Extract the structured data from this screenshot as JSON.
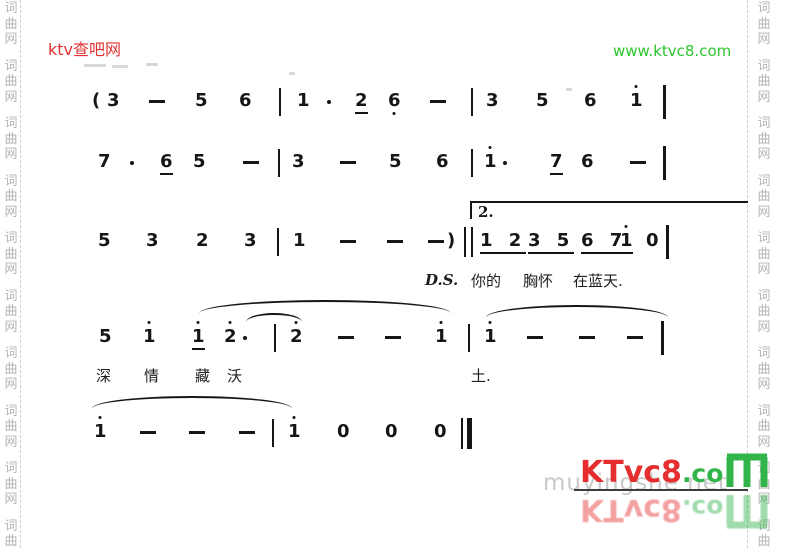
{
  "header": {
    "site_name": "ktv查吧网",
    "site_url": "www.ktvc8.com"
  },
  "side_watermark": {
    "chars": [
      "词",
      "曲",
      "网"
    ],
    "repeat": 10
  },
  "score": {
    "lines": [
      {
        "y": 91,
        "tokens": [
          {
            "k": "paren",
            "t": "(",
            "x": 92
          },
          {
            "k": "note",
            "t": "3",
            "x": 107
          },
          {
            "k": "dash",
            "x": 149
          },
          {
            "k": "note",
            "t": "5",
            "x": 195
          },
          {
            "k": "note",
            "t": "6",
            "x": 239
          },
          {
            "k": "bar",
            "x": 279
          },
          {
            "k": "note",
            "t": "1",
            "x": 297
          },
          {
            "k": "dot",
            "x": 327
          },
          {
            "k": "note",
            "t": "2",
            "x": 355,
            "ul": true
          },
          {
            "k": "note",
            "t": "6",
            "x": 388,
            "db": true
          },
          {
            "k": "dash",
            "x": 430
          },
          {
            "k": "bar",
            "x": 471
          },
          {
            "k": "note",
            "t": "3",
            "x": 486
          },
          {
            "k": "note",
            "t": "5",
            "x": 536
          },
          {
            "k": "note",
            "t": "6",
            "x": 584
          },
          {
            "k": "note",
            "t": "1",
            "x": 630,
            "da": true
          },
          {
            "k": "ebar",
            "x": 663
          }
        ]
      },
      {
        "y": 152,
        "tokens": [
          {
            "k": "note",
            "t": "7",
            "x": 98
          },
          {
            "k": "dot",
            "x": 130
          },
          {
            "k": "note",
            "t": "6",
            "x": 160,
            "ul": true
          },
          {
            "k": "note",
            "t": "5",
            "x": 193
          },
          {
            "k": "dash",
            "x": 243
          },
          {
            "k": "bar",
            "x": 278
          },
          {
            "k": "note",
            "t": "3",
            "x": 292
          },
          {
            "k": "dash",
            "x": 340
          },
          {
            "k": "note",
            "t": "5",
            "x": 389
          },
          {
            "k": "note",
            "t": "6",
            "x": 436
          },
          {
            "k": "bar",
            "x": 471
          },
          {
            "k": "note",
            "t": "1",
            "x": 484,
            "da": true
          },
          {
            "k": "dot",
            "x": 503
          },
          {
            "k": "note",
            "t": "7",
            "x": 550,
            "ul": true
          },
          {
            "k": "note",
            "t": "6",
            "x": 581
          },
          {
            "k": "dash",
            "x": 630
          },
          {
            "k": "ebar",
            "x": 663
          }
        ]
      },
      {
        "y": 231,
        "tokens": [
          {
            "k": "note",
            "t": "5",
            "x": 98
          },
          {
            "k": "note",
            "t": "3",
            "x": 146
          },
          {
            "k": "note",
            "t": "2",
            "x": 196
          },
          {
            "k": "note",
            "t": "3",
            "x": 244
          },
          {
            "k": "bar",
            "x": 277
          },
          {
            "k": "note",
            "t": "1",
            "x": 293
          },
          {
            "k": "dash",
            "x": 340
          },
          {
            "k": "dash",
            "x": 387
          },
          {
            "k": "dash",
            "x": 428
          },
          {
            "k": "paren",
            "t": ")",
            "x": 447
          },
          {
            "k": "dbar",
            "x": 464
          },
          {
            "k": "grp",
            "t": "1 2",
            "x": 480,
            "ul": true
          },
          {
            "k": "grp",
            "t": "3 5",
            "x": 528,
            "ul": true
          },
          {
            "k": "grp",
            "t": "6 7",
            "x": 581,
            "ul": true
          },
          {
            "k": "note",
            "t": "1",
            "x": 620,
            "ul": true,
            "da": true
          },
          {
            "k": "note",
            "t": "0",
            "x": 646
          },
          {
            "k": "ebar",
            "x": 666
          }
        ]
      },
      {
        "y": 327,
        "tokens": [
          {
            "k": "note",
            "t": "5",
            "x": 99
          },
          {
            "k": "note",
            "t": "1",
            "x": 143,
            "da": true
          },
          {
            "k": "note",
            "t": "1",
            "x": 192,
            "da": true,
            "ul": true
          },
          {
            "k": "note",
            "t": "2",
            "x": 224,
            "da": true
          },
          {
            "k": "dot",
            "x": 243
          },
          {
            "k": "bar",
            "x": 274
          },
          {
            "k": "note",
            "t": "2",
            "x": 290,
            "da": true
          },
          {
            "k": "dash",
            "x": 338
          },
          {
            "k": "dash",
            "x": 385
          },
          {
            "k": "note",
            "t": "1",
            "x": 435,
            "da": true
          },
          {
            "k": "bar",
            "x": 468
          },
          {
            "k": "note",
            "t": "1",
            "x": 484,
            "da": true
          },
          {
            "k": "dash",
            "x": 527
          },
          {
            "k": "dash",
            "x": 579
          },
          {
            "k": "dash",
            "x": 627
          },
          {
            "k": "ebar",
            "x": 661
          }
        ]
      },
      {
        "y": 422,
        "tokens": [
          {
            "k": "note",
            "t": "1",
            "x": 94,
            "da": true
          },
          {
            "k": "dash",
            "x": 140
          },
          {
            "k": "dash",
            "x": 189
          },
          {
            "k": "dash",
            "x": 239
          },
          {
            "k": "bar",
            "x": 272
          },
          {
            "k": "note",
            "t": "1",
            "x": 288,
            "da": true
          },
          {
            "k": "note",
            "t": "0",
            "x": 337
          },
          {
            "k": "note",
            "t": "0",
            "x": 385
          },
          {
            "k": "note",
            "t": "0",
            "x": 434
          },
          {
            "k": "fbar",
            "x": 461
          }
        ]
      }
    ],
    "lyrics": [
      {
        "t": "D.S.",
        "x": 425,
        "y": 271,
        "cls": "ds"
      },
      {
        "t": "你的",
        "x": 471,
        "y": 270
      },
      {
        "t": "胸怀",
        "x": 523,
        "y": 270
      },
      {
        "t": "在蓝天.",
        "x": 573,
        "y": 270
      },
      {
        "t": "深",
        "x": 96,
        "y": 365
      },
      {
        "t": "情",
        "x": 144,
        "y": 365
      },
      {
        "t": "藏",
        "x": 195,
        "y": 365
      },
      {
        "t": "沃",
        "x": 227,
        "y": 365
      },
      {
        "t": "土.",
        "x": 471,
        "y": 365
      }
    ],
    "slurs": [
      {
        "x": 199,
        "y": 300,
        "w": 252,
        "h": 14
      },
      {
        "x": 246,
        "y": 313,
        "w": 56,
        "h": 9
      },
      {
        "x": 486,
        "y": 305,
        "w": 182,
        "h": 13
      },
      {
        "x": 92,
        "y": 396,
        "w": 200,
        "h": 13
      }
    ],
    "volta": {
      "label": "2.",
      "x": 470,
      "y": 201,
      "w": 276
    },
    "artifacts": [
      {
        "x": 84,
        "y": 64,
        "w": 22
      },
      {
        "x": 112,
        "y": 65,
        "w": 16
      },
      {
        "x": 146,
        "y": 63,
        "w": 12
      },
      {
        "x": 289,
        "y": 72,
        "w": 6
      },
      {
        "x": 566,
        "y": 88,
        "w": 6
      }
    ]
  },
  "logo": {
    "text_red": "KTvc8",
    "text_green": ".co",
    "m_icon": "seven-segment-M",
    "ghost_text": "muyingshe net"
  },
  "colors": {
    "red": "#e03232",
    "green": "#2cc52c",
    "logo_red": "#e62e2e",
    "logo_green": "#31b44a",
    "gray_watermark": "#b5b5b5",
    "ink": "#161616"
  }
}
